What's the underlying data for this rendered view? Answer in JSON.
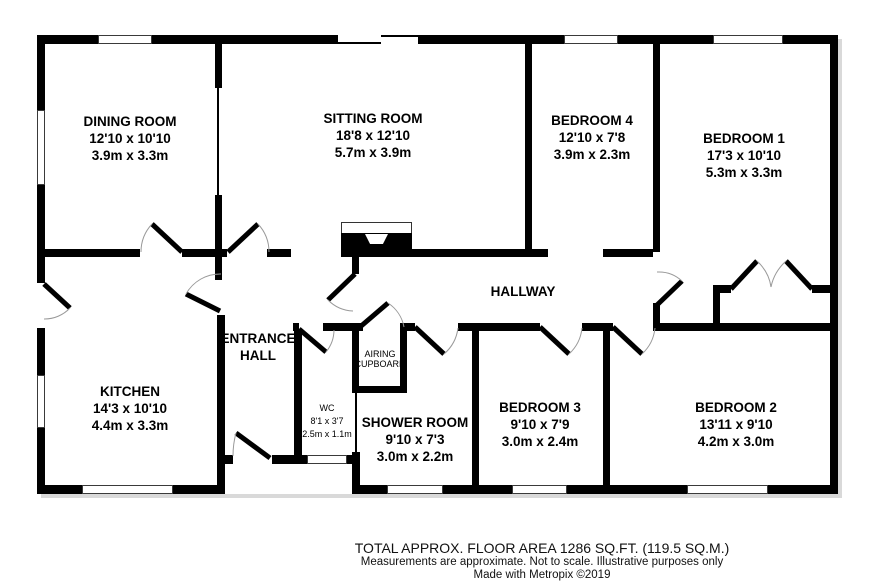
{
  "rooms": {
    "dining": {
      "name": "DINING ROOM",
      "imperial": "12'10 x 10'10",
      "metric": "3.9m x 3.3m"
    },
    "sitting": {
      "name": "SITTING ROOM",
      "imperial": "18'8 x 12'10",
      "metric": "5.7m x 3.9m"
    },
    "bedroom4": {
      "name": "BEDROOM 4",
      "imperial": "12'10 x 7'8",
      "metric": "3.9m x 2.3m"
    },
    "bedroom1": {
      "name": "BEDROOM 1",
      "imperial": "17'3 x 10'10",
      "metric": "5.3m x 3.3m"
    },
    "hallway": {
      "name": "HALLWAY"
    },
    "entrance_hall": {
      "line1": "ENTRANCE",
      "line2": "HALL"
    },
    "kitchen": {
      "name": "KITCHEN",
      "imperial": "14'3 x 10'10",
      "metric": "4.4m x 3.3m"
    },
    "wc": {
      "name": "WC",
      "imperial": "8'1 x 3'7",
      "metric": "2.5m x 1.1m"
    },
    "airing": {
      "line1": "AIRING",
      "line2": "CUPBOARD"
    },
    "shower": {
      "name": "SHOWER ROOM",
      "imperial": "9'10 x 7'3",
      "metric": "3.0m x 2.2m"
    },
    "bedroom3": {
      "name": "BEDROOM 3",
      "imperial": "9'10 x 7'9",
      "metric": "3.0m x 2.4m"
    },
    "bedroom2": {
      "name": "BEDROOM 2",
      "imperial": "13'11 x 9'10",
      "metric": "4.2m x 3.0m"
    }
  },
  "footer": {
    "area": "TOTAL APPROX. FLOOR AREA 1286 SQ.FT. (119.5 SQ.M.)",
    "disclaimer": "Measurements are approximate.  Not to scale.  Illustrative purposes only",
    "credit": "Made with Metropix ©2019"
  },
  "colors": {
    "wall": "#000000",
    "door_arc": "#999999",
    "shadow": "#d9d9d9"
  }
}
